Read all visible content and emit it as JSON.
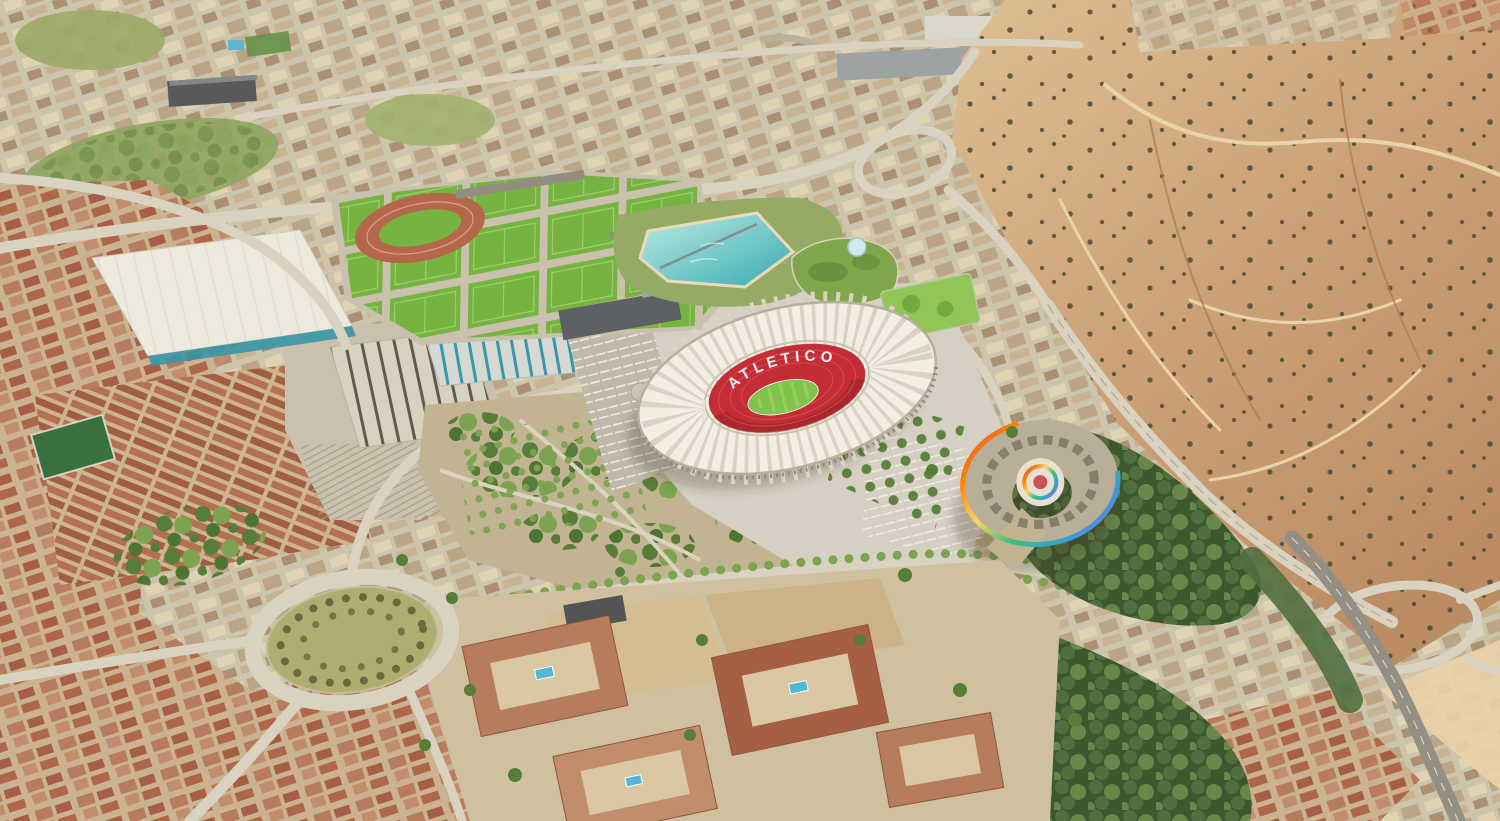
{
  "scene": {
    "stadium": {
      "roof_text": "ATLETICO"
    }
  },
  "colors": {
    "urban_base": "#cbc3ad",
    "urban_block_light": "#dfd3b4",
    "urban_block_mid": "#b9a385",
    "urban_block_dark": "#a78d72",
    "urban_block_warm": "#c4b291",
    "urban_red_base": "#c9b091",
    "terracotta_wall": "#b4765b",
    "terracotta_roof": "#a25840",
    "terracotta_mid": "#bf8a6a",
    "terracotta_deep": "#ab6146",
    "rowhouse_bg": "#cbb58f",
    "rowhouse_roof": "#9d5742",
    "rowhouse_roof2": "#b06b50",
    "barren_light": "#dcbd93",
    "barren_mid": "#c99d74",
    "barren_dark": "#b98a63",
    "shrub_dark": "#4b4a32",
    "path_sand": "#e9d2ab",
    "gully_brown": "#ad7a52",
    "road_light": "#d8d2c2",
    "road_mid": "#c7c0af",
    "asphalt": "#8f8c83",
    "rail_base": "#c7c0ae",
    "rail_line": "#9e977f",
    "shed_light": "#d6d1c2",
    "shed_stripe": "#57544a",
    "warehouse_white": "#edebe1",
    "warehouse_rib": "#dedbd0",
    "teal_accent": "#2f93a8",
    "teal_shed": "#d3d8d6",
    "field_green": "#6fb23c",
    "field_line": "#9ad06b",
    "track_red": "#b26148",
    "pitch_green": "#7cc24a",
    "pitch_stripe": "#8fd05a",
    "stadium_roof": "#f3f0e8",
    "stadium_rib": "#d9d3c6",
    "stadium_rim": "#b3ada0",
    "atleti_red": "#c12430",
    "atleti_red_dark": "#8f1b22",
    "seat_tier": "#d85a60",
    "seat_white": "#ffffff",
    "lagoon_light": "#b9ece6",
    "lagoon_deep": "#2fa9b4",
    "beach_sand": "#e8dcbb",
    "greenroof": "#7aa449",
    "greenroof_dark": "#5e8a38",
    "dome_glass": "#cfe9f2",
    "golf_green": "#8dc455",
    "golf_circle": "#69a83e",
    "esplanade": "#d4d0c7",
    "esplanade_dark": "#bcb8ac",
    "park_ground": "#bfb293",
    "tree_green": "#4f7a33",
    "tree_light": "#76a14e",
    "tree_deep": "#456f2e",
    "forest_bg": "#33512a",
    "forest_mid": "#48693a",
    "forest_light": "#5f8347",
    "roundabout_green": "#abab6f",
    "bush_olive": "#63653c",
    "pool_blue": "#47b6d8",
    "plaza_light": "#e7e2d6",
    "rainbow_body": "#b6ad99",
    "roof_detail": "#6e6a5e",
    "office_dark": "#565b60",
    "office_mid": "#9aa0a4",
    "dark_slab": "#4e5358",
    "rb_red": "#e63946",
    "rb_orange": "#f77f00",
    "rb_yellow": "#ffd166",
    "rb_green": "#2ec46f",
    "rb_blue": "#2d9cdb",
    "rb_purple": "#9b5de5",
    "shadow": "rgba(60,50,40,0.28)"
  }
}
